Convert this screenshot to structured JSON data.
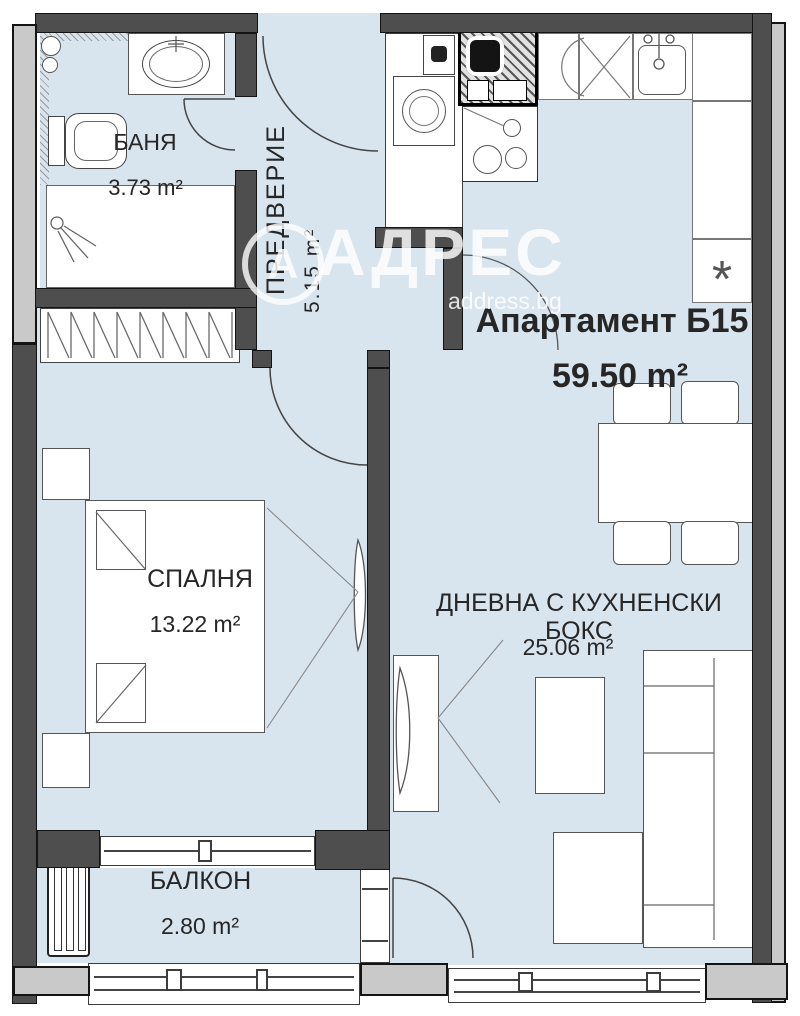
{
  "plan": {
    "apartment": {
      "label": "Апартамент Б15",
      "area": "59.50 m²"
    },
    "rooms": [
      {
        "name": "БАНЯ",
        "area": "3.73 m²"
      },
      {
        "name": "ПРЕДВЕРИЕ",
        "area": "5.15 m²"
      },
      {
        "name": "СПАЛНЯ",
        "area": "13.22 m²"
      },
      {
        "name": "ДНЕВНА С КУХНЕНСКИ БОКС",
        "area": "25.06 m²"
      },
      {
        "name": "БАЛКОН",
        "area": "2.80 m²"
      }
    ],
    "watermark": {
      "logo_letter": "А",
      "brand": "АДРЕС",
      "site": "address.bg"
    },
    "symbols": {
      "fridge_marker": "*"
    },
    "colors": {
      "floor": "#d8e4ee",
      "wall_dark": "#4e4e4e",
      "wall_light": "#c9c9c9"
    }
  }
}
